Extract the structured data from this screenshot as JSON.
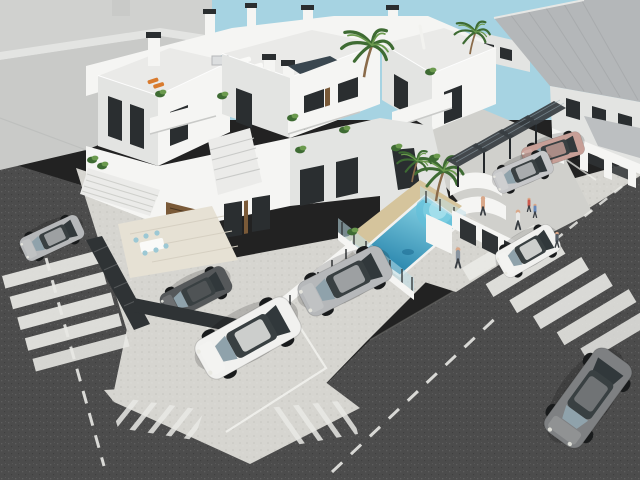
{
  "scene": {
    "type": "3D architectural exterior rendering (aerial view)",
    "subject": "Modern white Mediterranean apartment complex with rooftop solarium terraces, communal swimming pool, carport pergolas and street parking at a road intersection",
    "time_of_day": "daytime, clear light-blue sky",
    "no_visible_text": true
  },
  "colors": {
    "sky": "#a6d3e2",
    "asphalt": "#4c4c4c",
    "asphalt_light": "#5a5a5a",
    "marking": "#e9e9e5",
    "pavement": "#d6d5d0",
    "pavement_dark": "#c6c5c0",
    "driveway": "#d0d0cc",
    "building_white": "#f5f5f3",
    "building_shade": "#e3e4e2",
    "building_dark": "#cfd0ce",
    "terrace_floor": "#eaeae8",
    "gray_building": "#d0d1cf",
    "gray_building_wall": "#c9cac8",
    "roof_gray": "#b4b7b9",
    "roof_gray_2": "#bcbfc1",
    "window_dark": "#2a2e30",
    "glass_blue": "#8fa2ab",
    "wood": "#7a5a38",
    "fence_dark": "#2f3335",
    "pergola": "#383d42",
    "glass_fence": "#bfe0ea",
    "sand": "#d5c49c",
    "pool_light": "#8ed9e9",
    "pool_deep": "#1e7ca6",
    "green_dark": "#3e6b33",
    "green_light": "#6b9a4e",
    "trunk": "#8a6b4a",
    "step_light": "#ebebe9",
    "tile": "#e6e1d4",
    "skin": "#d9a88a",
    "accent_orange": "#d97b2e",
    "car_white": "#f1f1ef",
    "car_silver": "#b6b8ba",
    "car_light_silver": "#c6c7c9",
    "car_dark_gray": "#55585a",
    "car_sports_gray": "#7e8082",
    "car_champagne": "#c79f97"
  },
  "objects": {
    "buildings": [
      {
        "name": "main-apartment-complex",
        "style": "white modern blocks, stepped balconies, rooftop terraces with chimneys, plants, loungers and a dining set"
      },
      {
        "name": "neighbor-building-left",
        "style": "large plain light-gray building with white fascia"
      },
      {
        "name": "townhouses-right",
        "style": "row houses with gray standing-seam pitched roofs and white balconies"
      }
    ],
    "pool": {
      "shape": "rectangular",
      "features": [
        "curved roman steps",
        "glass safety fence",
        "sand-colored deck",
        "palm trees"
      ]
    },
    "vehicles": [
      {
        "name": "white-coupe",
        "color": "white",
        "state": "parked in marked bay"
      },
      {
        "name": "silver-sedan",
        "color": "silver",
        "state": "parked by pool wall"
      },
      {
        "name": "gray-sports-car",
        "color": "gunmetal gray",
        "state": "driving on main road"
      },
      {
        "name": "white-mini",
        "color": "white",
        "state": "crossing zebra crossing"
      },
      {
        "name": "champagne-sedan",
        "color": "champagne",
        "state": "parked in driveway"
      },
      {
        "name": "light-silver-sedan",
        "color": "light silver",
        "state": "parked in driveway"
      },
      {
        "name": "silver-hatchback",
        "color": "silver",
        "state": "parked on left street"
      },
      {
        "name": "dark-gray-car",
        "color": "dark gray",
        "state": "parked behind fence"
      }
    ],
    "people": [
      {
        "name": "pedestrian-sidewalk",
        "clothing": "gray-blue"
      },
      {
        "name": "woman-by-pool",
        "clothing": "swimwear"
      },
      {
        "name": "man-white-shirt",
        "clothing": "white shirt, dark trousers"
      },
      {
        "name": "child-red"
      },
      {
        "name": "child-blue"
      },
      {
        "name": "pedestrian-at-crossing"
      }
    ],
    "road_markings": {
      "zebra_crossings": 2,
      "dashed_lane_lines": 3,
      "chevron_hatch_patches": 2,
      "parking_bay_lines": true
    },
    "vegetation": {
      "palm_trees": 5,
      "shrub_clusters": "multiple on balconies and planters"
    }
  }
}
